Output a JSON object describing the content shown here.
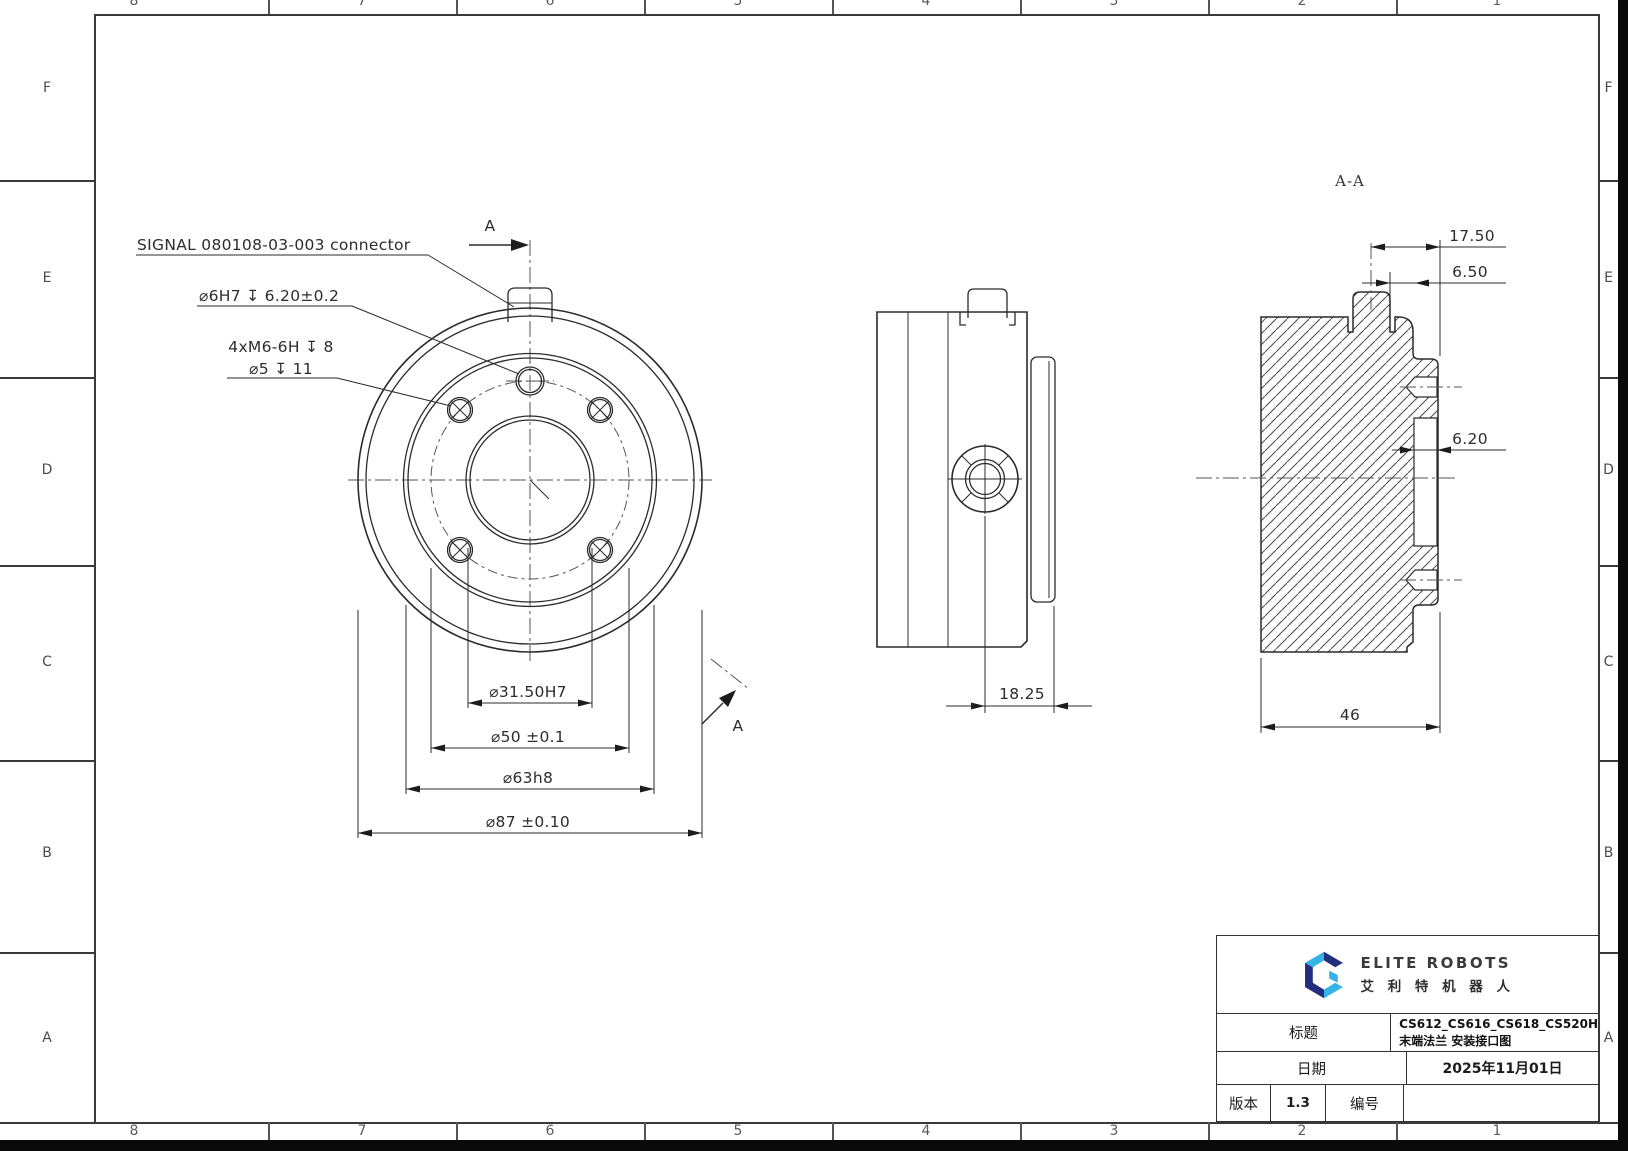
{
  "zones": {
    "rows": [
      "F",
      "E",
      "D",
      "C",
      "B",
      "A"
    ],
    "cols": [
      "8",
      "7",
      "6",
      "5",
      "4",
      "3",
      "2",
      "1"
    ]
  },
  "front_view": {
    "connector_label": "SIGNAL 080108-03-003 connector",
    "dowel_hole_label": "⌀6H7 ↧ 6.20±0.2",
    "bolt_holes_label_line1": "4xM6-6H ↧ 8",
    "bolt_holes_label_line2": "⌀5 ↧ 11",
    "dim_bore": "⌀31.50H7",
    "dim_bolt_circle": "⌀50 ±0.1",
    "dim_spigot": "⌀63h8",
    "dim_flange": "⌀87 ±0.10",
    "section_arrow_label": "A"
  },
  "side_view": {
    "dim_hole_to_face": "18.25"
  },
  "section_view": {
    "title": "A-A",
    "dim_connector_center": "17.50",
    "dim_connector_edge": "6.50",
    "dim_spigot_wall": "6.20",
    "dim_overall_depth": "46"
  },
  "title_block": {
    "logo": {
      "brand_en": "ELITE ROBOTS",
      "brand_cn": "艾 利 特 机 器 人",
      "color_navy": "#232f7e",
      "color_blue": "#35b3e6"
    },
    "title_label": "标题",
    "title_value_line1": "CS612_CS616_CS618_CS520H",
    "title_value_line2": "末端法兰 安装接口图",
    "date_label": "日期",
    "date_value": "2025年11月01日",
    "version_label": "版本",
    "version_value": "1.3",
    "number_label": "编号",
    "number_value": ""
  }
}
